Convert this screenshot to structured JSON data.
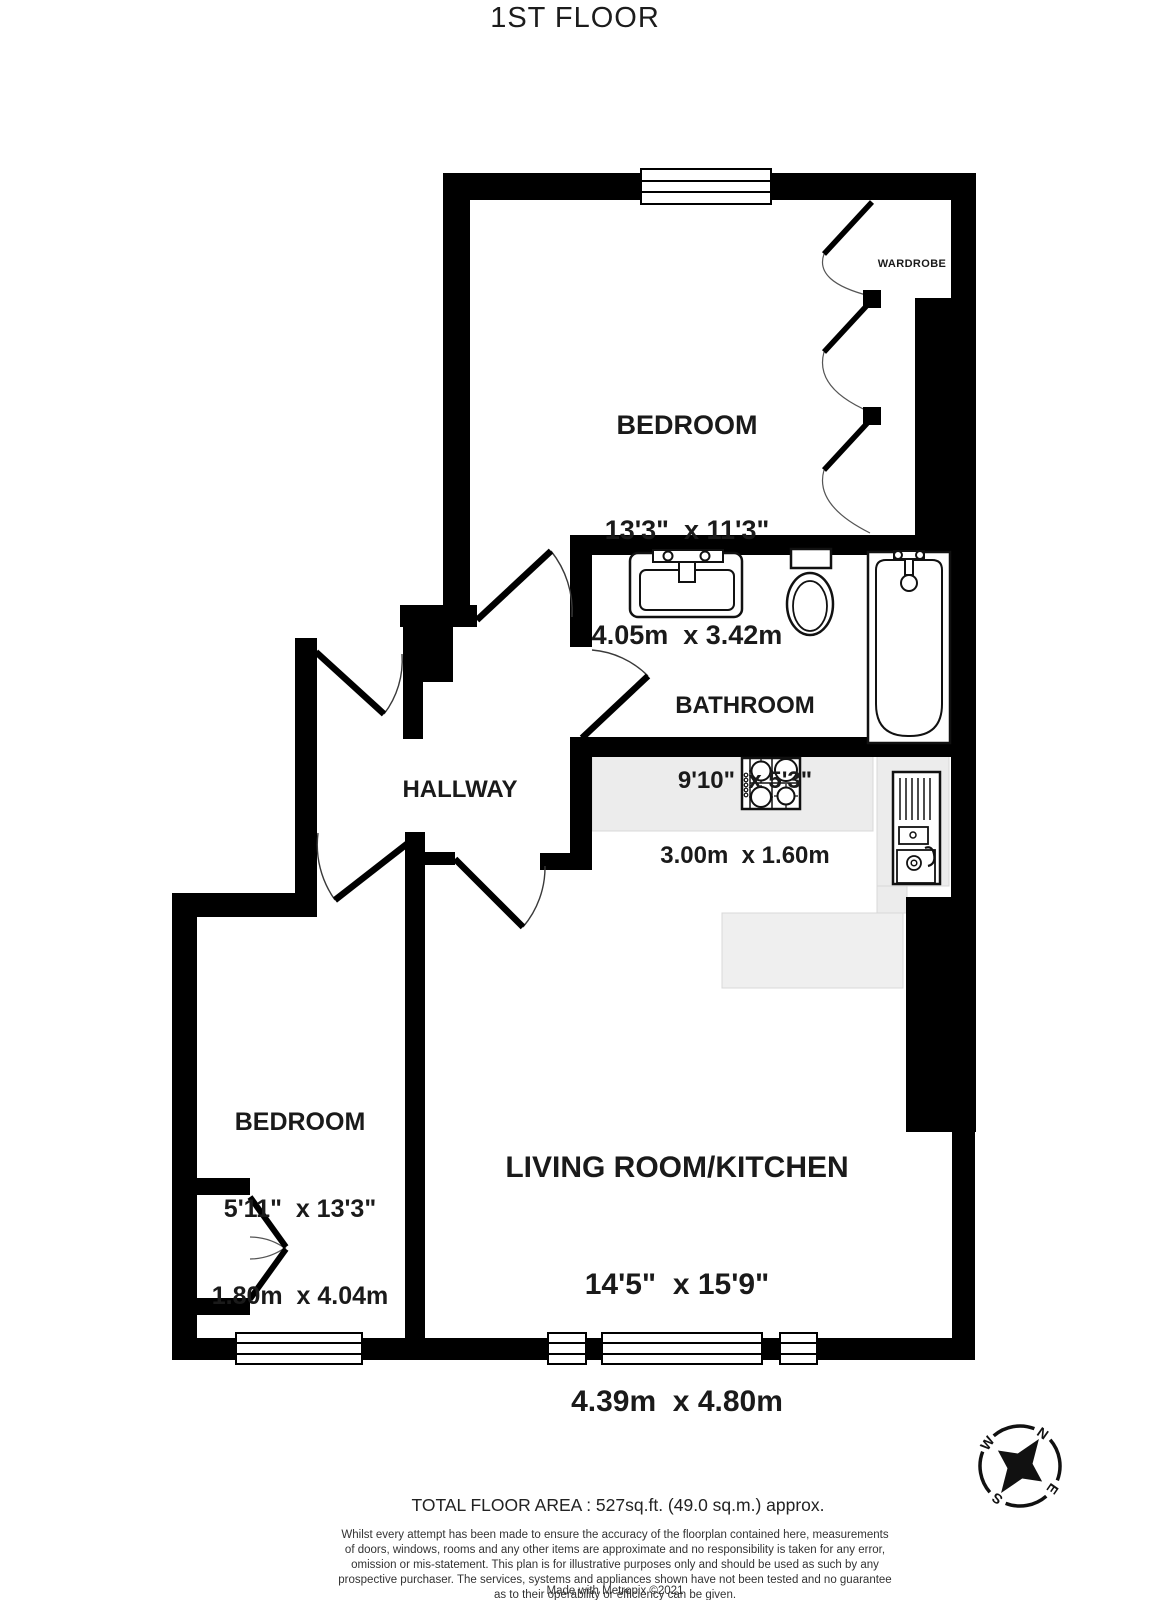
{
  "title": "1ST FLOOR",
  "rooms": [
    {
      "id": "bedroom1",
      "name": "BEDROOM",
      "imperial": "13'3\"  x 11'3\"",
      "metric": "4.05m  x 3.42m"
    },
    {
      "id": "bathroom",
      "name": "BATHROOM",
      "imperial": "9'10\"  x 5'3\"",
      "metric": "3.00m  x 1.60m"
    },
    {
      "id": "hallway",
      "name": "HALLWAY"
    },
    {
      "id": "bedroom2",
      "name": "BEDROOM",
      "imperial": "5'11\"  x 13'3\"",
      "metric": "1.80m  x 4.04m"
    },
    {
      "id": "living",
      "name": "LIVING ROOM/KITCHEN",
      "imperial": "14'5\"  x 15'9\"",
      "metric": "4.39m  x 4.80m"
    }
  ],
  "labels": {
    "wardrobe": "WARDROBE"
  },
  "compass": {
    "n": "N",
    "e": "E",
    "s": "S",
    "w": "W"
  },
  "footer": {
    "total_area": "TOTAL FLOOR AREA : 527sq.ft. (49.0 sq.m.) approx.",
    "lines": [
      "Whilst every attempt has been made to ensure the accuracy of the floorplan contained here, measurements",
      "of doors, windows, rooms and any other items are approximate and no responsibility is taken for any error,",
      "omission or mis-statement. This plan is for illustrative purposes only and should be used as such by any",
      "prospective purchaser. The services, systems and appliances shown have not been tested and no guarantee",
      "as to their operability or efficiency can be given."
    ],
    "credit": "Made with Metropix ©2021"
  },
  "colors": {
    "wall": "#000000",
    "counter": "#ececec",
    "text": "#1a1a1a"
  }
}
